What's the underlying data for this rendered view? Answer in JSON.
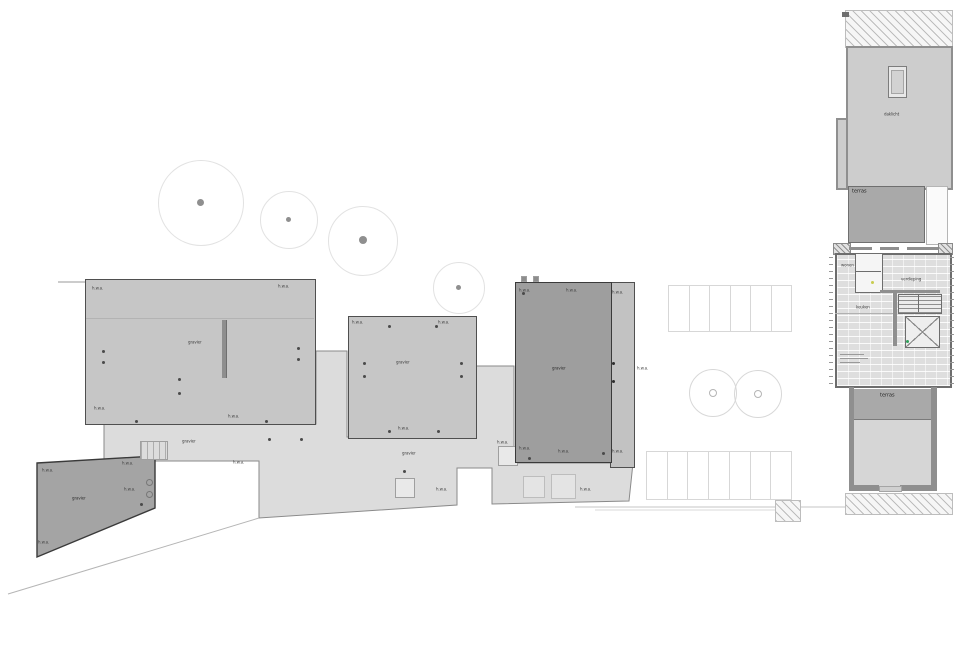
{
  "labels": {
    "roof": "gravier",
    "terrace": "terras",
    "drain": "h.w.a.",
    "skylight": "daklicht",
    "room_living": "wonen",
    "room_kitchen": "keuken",
    "floor_note": "verdieping"
  },
  "parking": {
    "upper": {
      "count": 6
    },
    "lower": {
      "count": 7
    }
  },
  "colors": {
    "plaza": "#dcdcdc",
    "roof_light": "#c6c6c6",
    "roof_dark": "#9e9e9e",
    "terrace": "#a9a9a9",
    "wall": "#8f8f8f",
    "marker_green": "#2fa05a",
    "marker_yellow": "#c8cc4f"
  }
}
